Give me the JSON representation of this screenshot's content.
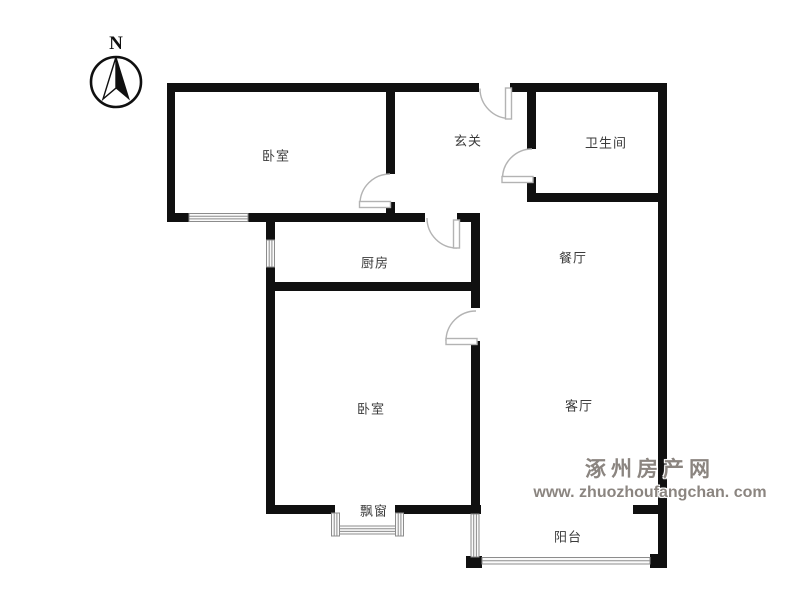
{
  "compass": {
    "label": "N"
  },
  "rooms": [
    {
      "name": "bedroom-top",
      "label": "卧室"
    },
    {
      "name": "hallway",
      "label": "玄关"
    },
    {
      "name": "bathroom",
      "label": "卫生间"
    },
    {
      "name": "kitchen",
      "label": "厨房"
    },
    {
      "name": "dining-room",
      "label": "餐厅"
    },
    {
      "name": "bedroom-bottom",
      "label": "卧室"
    },
    {
      "name": "living-room",
      "label": "客厅"
    },
    {
      "name": "bay-window",
      "label": "飘窗"
    },
    {
      "name": "balcony",
      "label": "阳台"
    }
  ],
  "watermark": {
    "site_name": "涿州房产网",
    "url": "www. zhuozhoufangchan. com",
    "color": "#8b8580"
  },
  "icons": {
    "north_arrow": "compass-needle-half-filled",
    "door": "quarter-circle-swing",
    "window": "striped-band"
  },
  "colors": {
    "wall": "#101010",
    "door_symbol": "#b3b3b3",
    "window_symbol": "#8c8c8c",
    "label_text": "#3b3b3b",
    "background": "#ffffff"
  }
}
